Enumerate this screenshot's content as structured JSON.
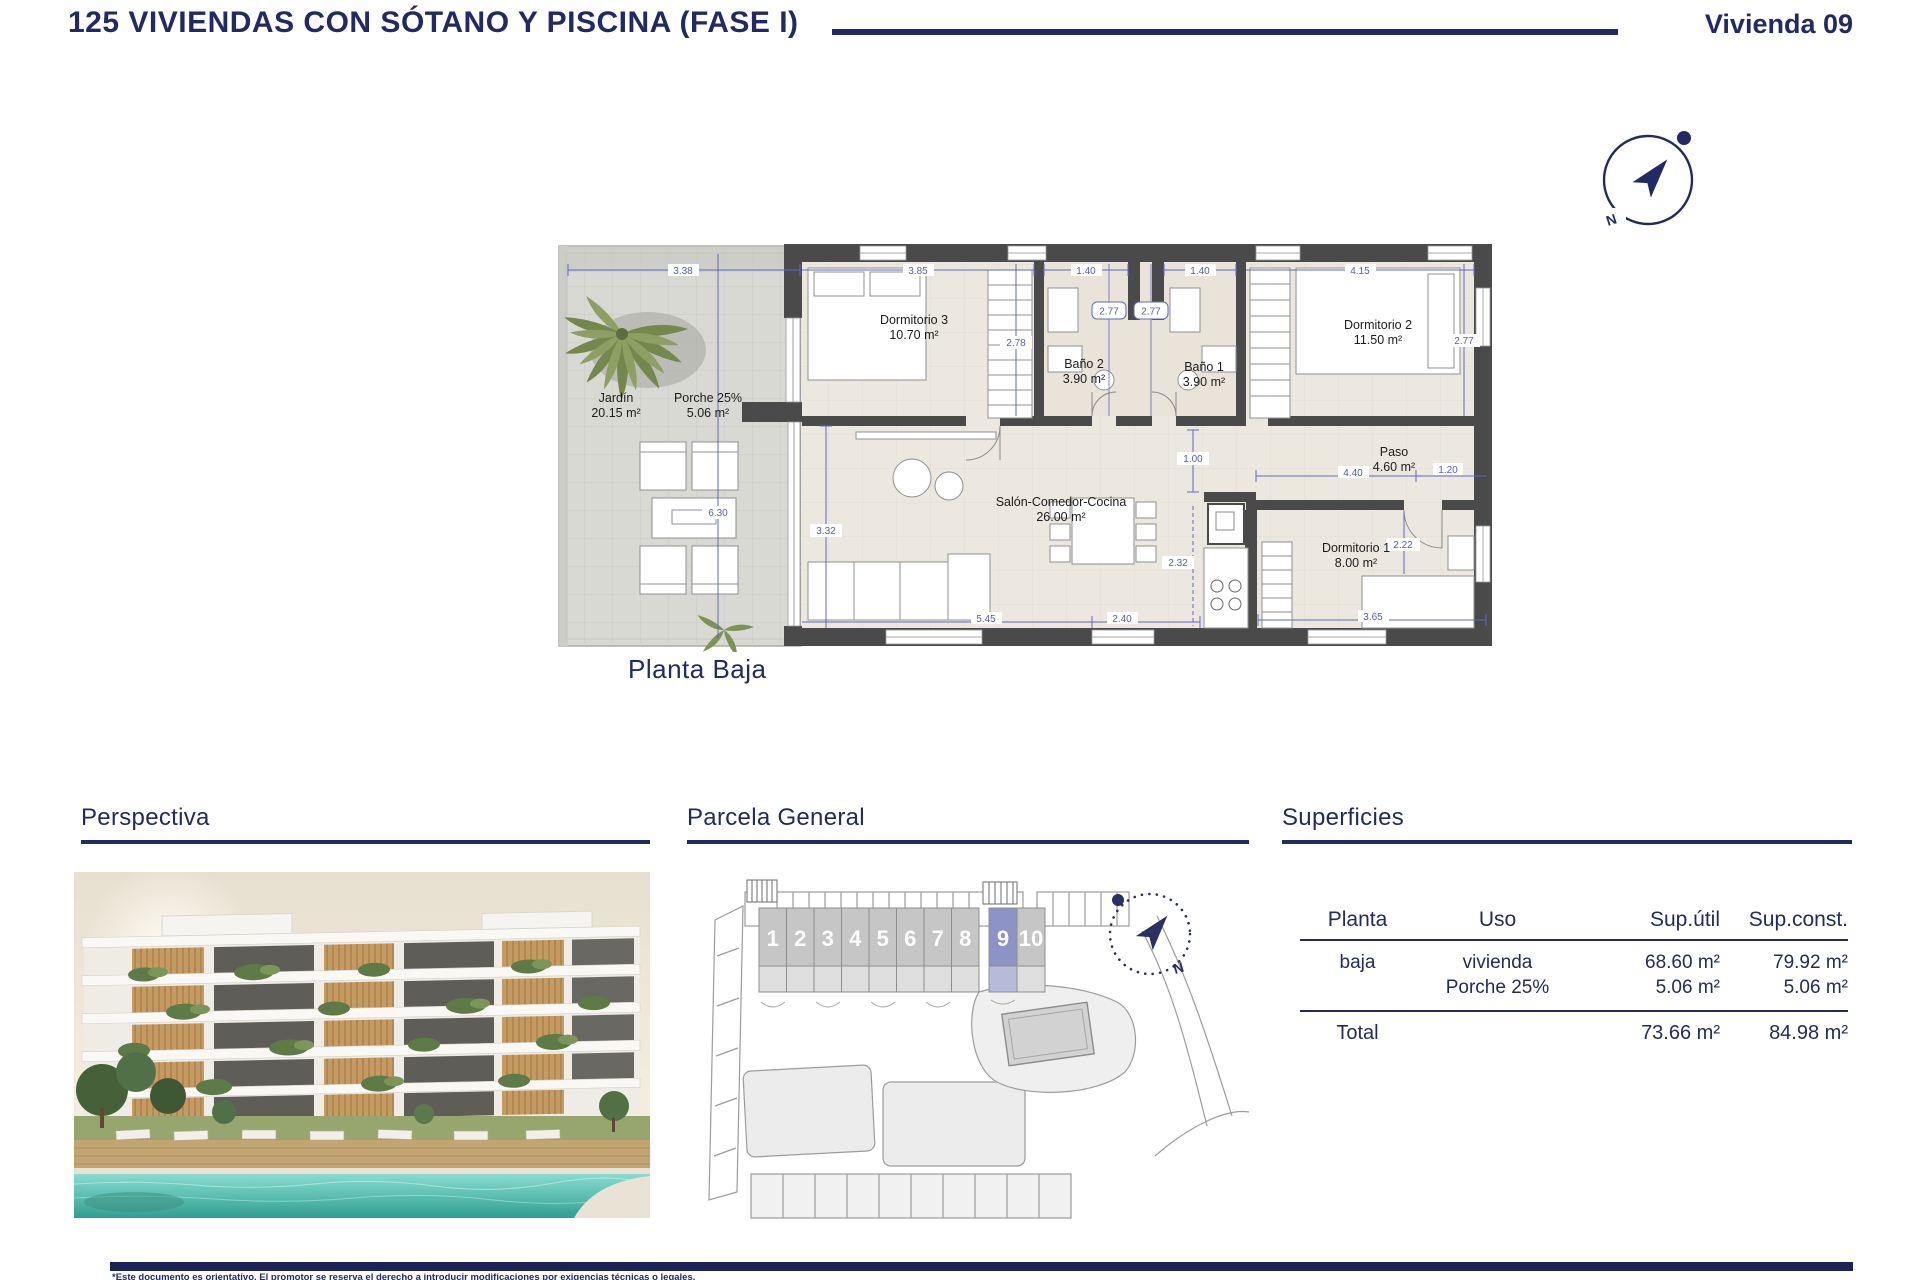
{
  "header": {
    "title": "125 VIVIENDAS CON SÓTANO Y PISCINA (FASE I)",
    "unit": "Vivienda 09"
  },
  "compass": {
    "north": "N"
  },
  "floor_plan": {
    "label": "Planta Baja",
    "rooms": [
      {
        "name": "Jardín",
        "area": "20.15 m²"
      },
      {
        "name": "Porche 25%",
        "area": "5.06 m²"
      },
      {
        "name": "Dormitorio 3",
        "area": "10.70 m²"
      },
      {
        "name": "Baño 2",
        "area": "3.90 m²"
      },
      {
        "name": "Baño 1",
        "area": "3.90 m²"
      },
      {
        "name": "Dormitorio 2",
        "area": "11.50 m²"
      },
      {
        "name": "Salón-Comedor-Cocina",
        "area": "26.00 m²"
      },
      {
        "name": "Paso",
        "area": "4.60 m²"
      },
      {
        "name": "Dormitorio 1",
        "area": "8.00 m²"
      }
    ],
    "dims": {
      "garden_width": "3.38",
      "dorm3_width": "3.85",
      "bano2_width": "1.40",
      "bano1_width": "1.40",
      "dorm2_width": "4.15",
      "dorm3_depth": "2.78",
      "bano2_depth": "2.77",
      "bano1_depth": "2.77",
      "dorm2_depth": "2.77",
      "garden_depth": "6.30",
      "salon_left": "3.32",
      "hall_width": "1.00",
      "paso_width": "4.40",
      "paso_depth": "1.20",
      "kitchen_depth": "2.32",
      "dorm1_depth": "2.22",
      "salon_width": "5.45",
      "kitchen_width": "2.40",
      "dorm1_width": "3.65"
    }
  },
  "sections": {
    "perspectiva": {
      "title": "Perspectiva"
    },
    "parcela": {
      "title": "Parcela General",
      "units": [
        "1",
        "2",
        "3",
        "4",
        "5",
        "6",
        "7",
        "8",
        "9",
        "10"
      ],
      "highlighted_unit": "9"
    },
    "superficies": {
      "title": "Superficies",
      "table": {
        "headers": [
          "Planta",
          "Uso",
          "Sup.útil",
          "Sup.const."
        ],
        "rows": [
          {
            "planta": "baja",
            "uso": "vivienda",
            "util": "68.60 m²",
            "const": "79.92 m²"
          },
          {
            "planta": "",
            "uso": "Porche 25%",
            "util": "5.06 m²",
            "const": "5.06 m²"
          }
        ],
        "total": {
          "label": "Total",
          "util": "73.66 m²",
          "const": "84.98 m²"
        }
      }
    }
  },
  "footer": {
    "disclaimer": "*Este documento es orientativo. El promotor se reserva el derecho a introducir modificaciones por exigencias técnicas o legales."
  },
  "colors": {
    "navy": "#232a63",
    "dimension_blue": "#6066c6",
    "wall_grey": "#4a4a4a",
    "floor_beige": "#ece8e0",
    "unit_highlight": "#8e93c7"
  }
}
